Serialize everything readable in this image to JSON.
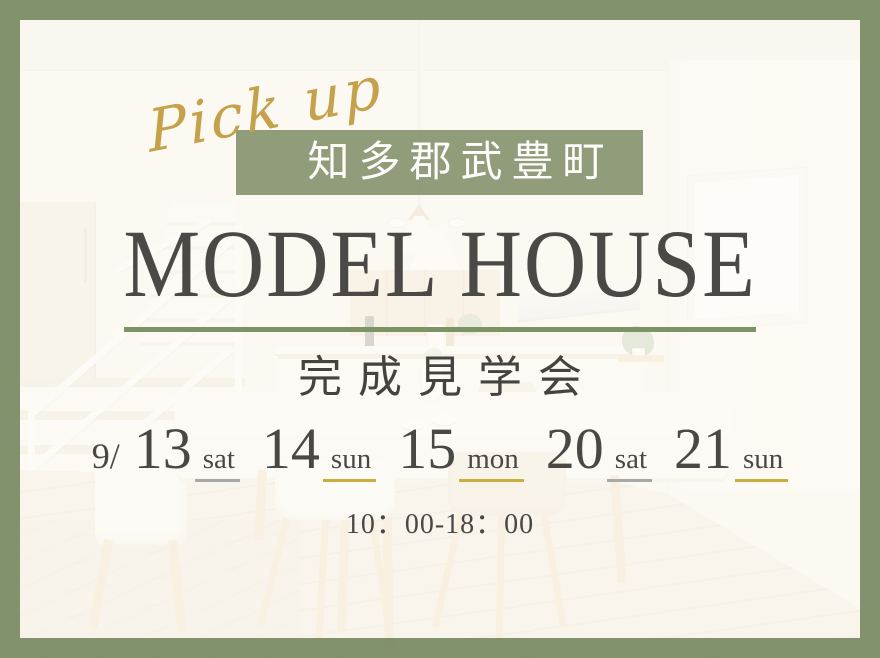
{
  "pickup": {
    "text": "Pick up",
    "color": "#c5a14b"
  },
  "location": {
    "text": "知多郡武豊町",
    "bg_color": "#7c8c64",
    "text_color": "#fdfdfb"
  },
  "title": {
    "text": "MODEL HOUSE",
    "color": "#4b4946"
  },
  "divider": {
    "color": "#7e9365"
  },
  "event": {
    "text": "完成見学会"
  },
  "schedule": {
    "month_prefix": "9/",
    "dates": [
      {
        "day": "13",
        "weekday": "sat",
        "underline": "gray"
      },
      {
        "day": "14",
        "weekday": "sun",
        "underline": "gold"
      },
      {
        "day": "15",
        "weekday": "mon",
        "underline": "gold"
      },
      {
        "day": "20",
        "weekday": "sat",
        "underline": "gray"
      },
      {
        "day": "21",
        "weekday": "sun",
        "underline": "gold"
      }
    ],
    "underline_colors": {
      "gray": "#a8a8a8",
      "gold": "#c9ad3e"
    },
    "time": "10：00-18：00"
  },
  "frame": {
    "border_color": "#788a63"
  }
}
